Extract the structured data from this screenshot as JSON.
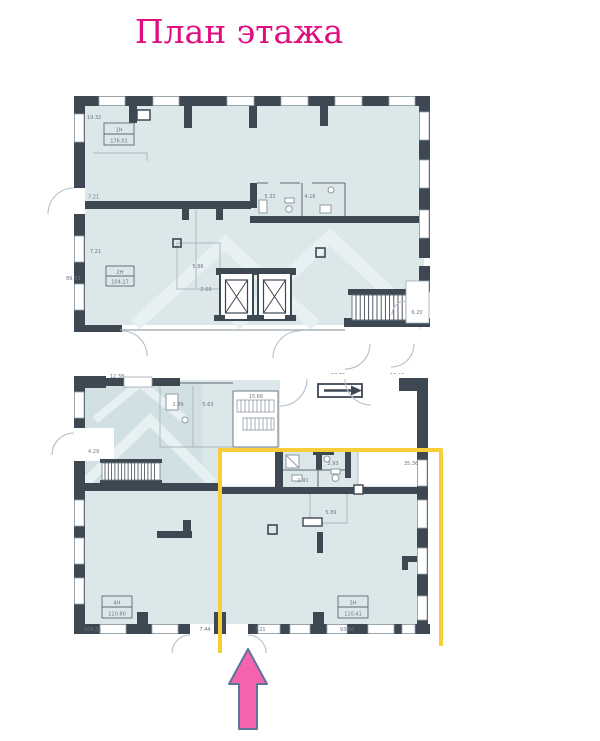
{
  "title": "План этажа",
  "colors": {
    "title": "#e00d80",
    "room_fill": "#dbe7e9",
    "wall": "#3d4853",
    "highlight": "#f7cd3a",
    "arrow_fill": "#f463ae",
    "arrow_stroke": "#5f739b"
  },
  "plan": {
    "units": [
      {
        "label": "1Н",
        "area": "176.01"
      },
      {
        "label": "2Н",
        "area": "104.27"
      },
      {
        "label": "4Н",
        "area": "110.80"
      },
      {
        "label": "3Н",
        "area": "110.41"
      }
    ],
    "dims": {
      "top_area": "19.32",
      "left_a": "7.21",
      "left_b": "7.21",
      "area_2h_side": "89.83",
      "wc_a": "5.96",
      "wc_b": "2.09",
      "bath_a": "5.32",
      "bath_b": "4.16",
      "stair_up": "6.20",
      "strip_a": "12.38",
      "strip_b": "58.75",
      "strip_c": "13.46",
      "low_a": "2.89",
      "low_b": "5.63",
      "low_stair": "15.66",
      "low_notch": "4.29",
      "yel_a": "2.93",
      "yel_b": "2.91",
      "yel_c": "35.36",
      "yel_d": "5.89",
      "bot_a": "104.31",
      "bot_b": "7.44",
      "bot_c": "7.21",
      "bot_d": "93.68"
    }
  }
}
